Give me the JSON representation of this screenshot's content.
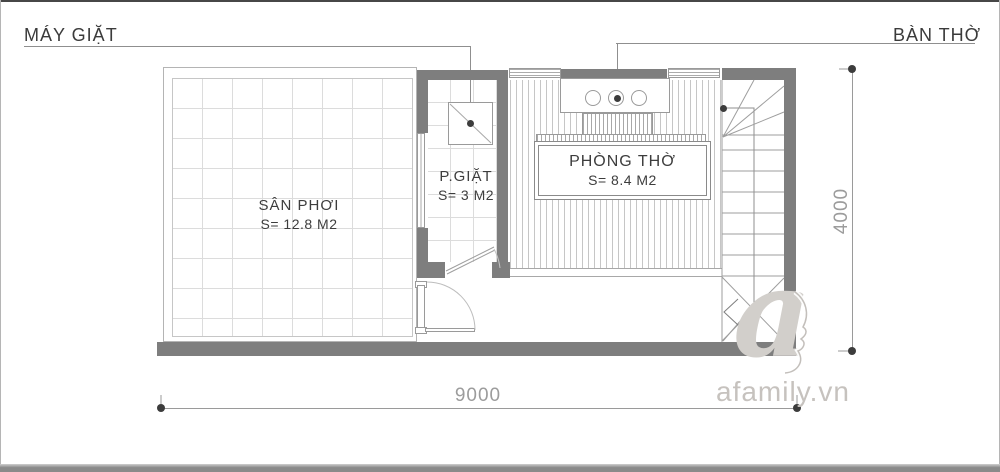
{
  "header": {
    "left_label": "MÁY GIẶT",
    "right_label": "BÀN THỜ"
  },
  "rooms": {
    "san_phoi": {
      "name": "SÂN PHƠI",
      "area": "S= 12.8 M2"
    },
    "p_giat": {
      "name": "P.GIẶT",
      "area": "S= 3 M2"
    },
    "phong_tho": {
      "name": "PHÒNG THỜ",
      "area": "S= 8.4 M2"
    }
  },
  "dimensions": {
    "width_mm": "9000",
    "height_mm": "4000"
  },
  "watermark": {
    "logo_letter": "a",
    "text": "afamily.vn"
  },
  "colors": {
    "wall": "#7e7e7e",
    "thin_line": "#9a9a9a",
    "text": "#3d3d3d",
    "dimension": "#9c9c9c",
    "watermark": "#c9c5c1"
  }
}
